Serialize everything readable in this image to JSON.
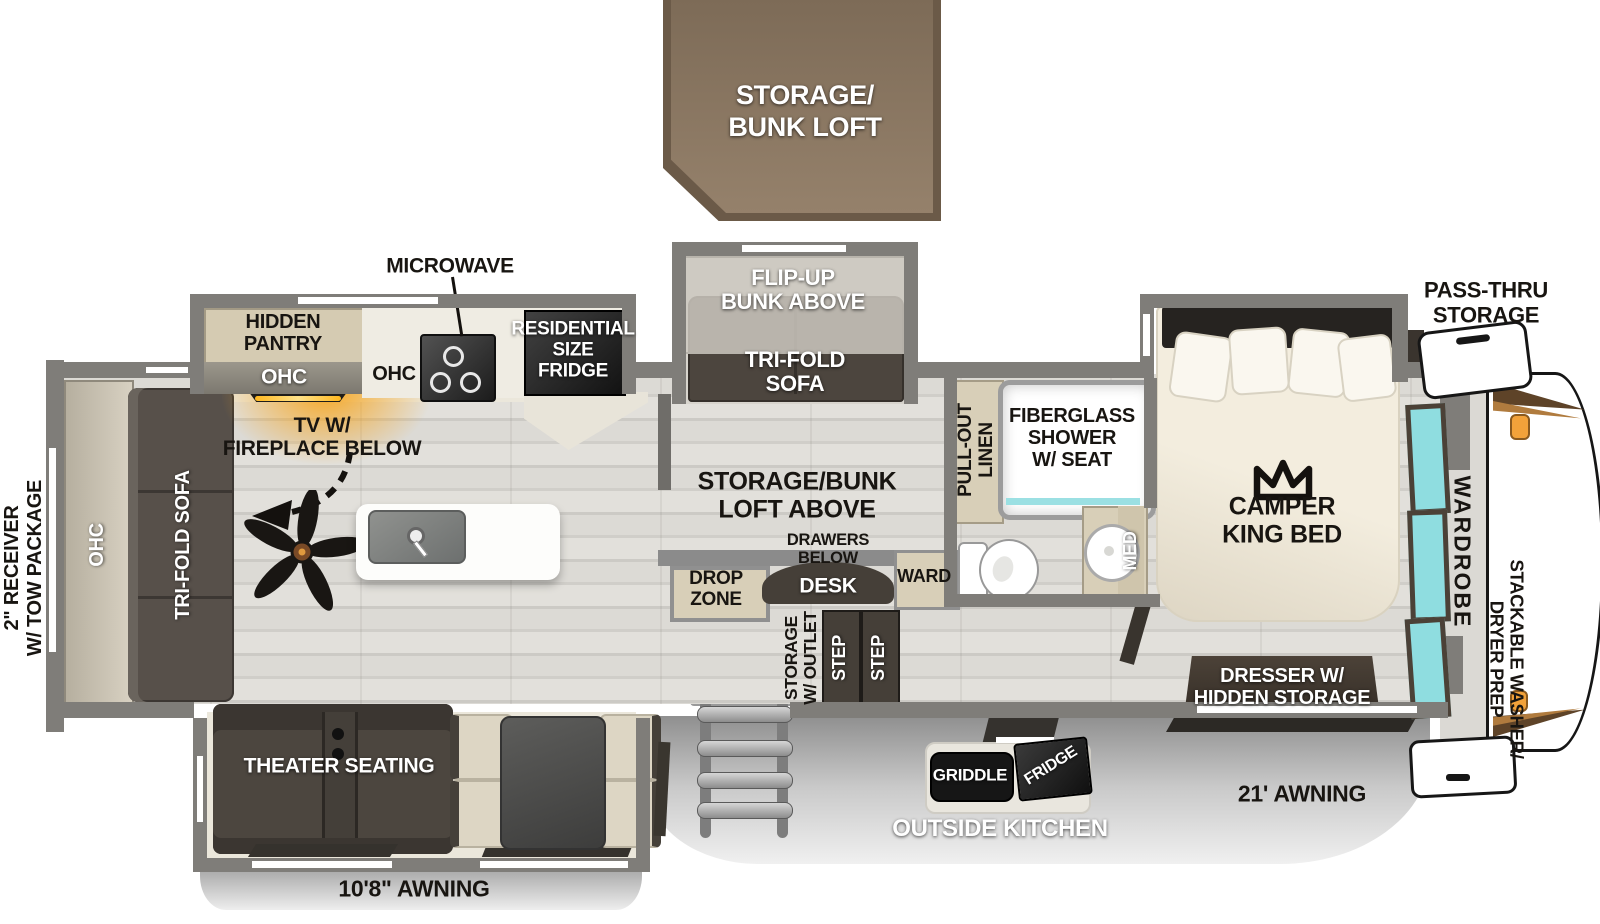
{
  "colors": {
    "wall": "#7f7d79",
    "floor_wood": "#d9d7d2",
    "slide_floor": "#ebe7db",
    "dark_furniture": "#4c463f",
    "tan_cabinet": "#d8cfb8",
    "loft_brown": "#8a7561",
    "window_teal": "#8fdde0",
    "glow_orange": "#f2a23a",
    "awning_gray": "#bdbdbd"
  },
  "loft_box": {
    "lines": [
      "STORAGE/",
      "BUNK LOFT"
    ]
  },
  "exterior": {
    "receiver": {
      "lines": [
        "2\" RECEIVER",
        "W/ TOW PACKAGE"
      ]
    },
    "pass_thru": {
      "lines": [
        "PASS-THRU",
        "STORAGE"
      ]
    },
    "awning_left": "10'8\" AWNING",
    "awning_right": "21' AWNING",
    "outside_kitchen": "OUTSIDE KITCHEN",
    "griddle": "GRIDDLE",
    "outside_fridge": "FRIDGE"
  },
  "living": {
    "ohc_rear": "OHC",
    "tri_fold_sofa": "TRI-FOLD SOFA",
    "tv": {
      "lines": [
        "TV W/",
        "FIREPLACE BELOW"
      ]
    },
    "theater_seating": "THEATER SEATING"
  },
  "kitchen": {
    "microwave": "MICROWAVE",
    "hidden_pantry": {
      "lines": [
        "HIDDEN",
        "PANTRY"
      ]
    },
    "ohc_shelf": "OHC",
    "ohc_counter": "OHC",
    "residential_fridge": {
      "lines": [
        "RESIDENTIAL",
        "SIZE",
        "FRIDGE"
      ]
    }
  },
  "bunk_room": {
    "flip_up_bunk": {
      "lines": [
        "FLIP-UP",
        "BUNK ABOVE"
      ]
    },
    "tri_fold_sofa": {
      "lines": [
        "TRI-FOLD",
        "SOFA"
      ]
    },
    "loft_above": {
      "lines": [
        "STORAGE/BUNK",
        "LOFT ABOVE"
      ]
    },
    "drawers_below": {
      "lines": [
        "DRAWERS",
        "BELOW"
      ]
    },
    "desk": "DESK",
    "ward": "WARD",
    "drop_zone": {
      "lines": [
        "DROP",
        "ZONE"
      ]
    },
    "storage_outlet": {
      "lines": [
        "STORAGE",
        "W/ OUTLET"
      ]
    },
    "steps": [
      "STEP",
      "STEP"
    ]
  },
  "bathroom": {
    "shower": {
      "lines": [
        "FIBERGLASS",
        "SHOWER",
        "W/ SEAT"
      ]
    },
    "pull_out_linen": {
      "lines": [
        "PULL-OUT",
        "LINEN"
      ]
    },
    "med": "MED"
  },
  "bedroom": {
    "bed": {
      "lines": [
        "CAMPER",
        "KING BED"
      ]
    },
    "dresser": {
      "lines": [
        "DRESSER W/",
        "HIDDEN STORAGE"
      ]
    },
    "wardrobe": "WARDROBE",
    "washer": {
      "lines": [
        "STACKABLE WASHER/",
        "DRYER PREP"
      ]
    }
  }
}
